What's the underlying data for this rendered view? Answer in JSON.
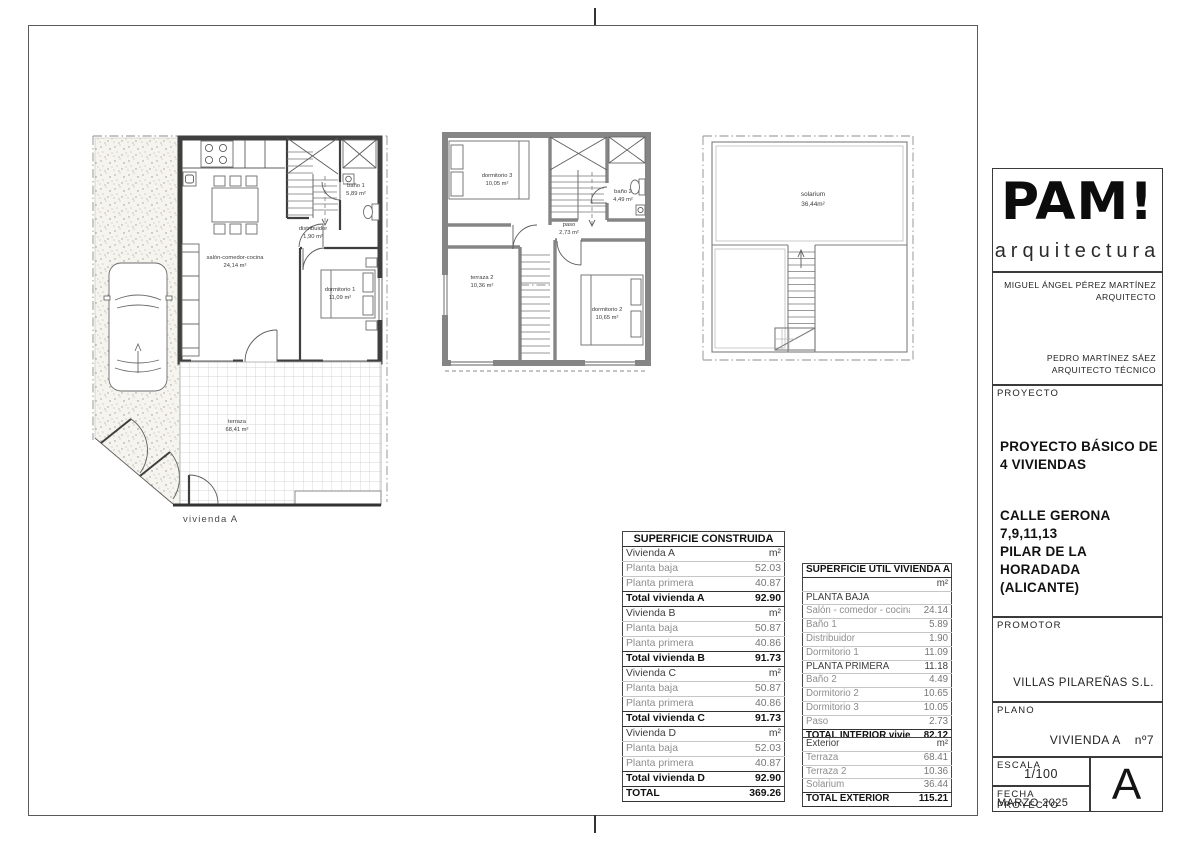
{
  "title_block": {
    "logo_title": "PAM!",
    "logo_subtitle": "arquitectura",
    "architect_name": "MIGUEL ÁNGEL PÉREZ MARTÍNEZ",
    "architect_role": "ARQUITECTO",
    "technical_architect_name": "PEDRO MARTÍNEZ SÁEZ",
    "technical_architect_role": "ARQUITECTO TÉCNICO",
    "proyecto_label": "PROYECTO",
    "project_title_line1": "PROYECTO BÁSICO DE",
    "project_title_line2": "4 VIVIENDAS",
    "address_line1": "CALLE GERONA",
    "address_line2": "7,9,11,13",
    "address_line3": "PILAR DE LA HORADADA",
    "address_line4": "(ALICANTE)",
    "promotor_label": "PROMOTOR",
    "promotor_name": "VILLAS PILAREÑAS S.L.",
    "plano_label": "PLANO",
    "plano_name": "VIVIENDA A",
    "plano_number": "nº7",
    "escala_label": "ESCALA",
    "escala_value": "1/100",
    "fecha_label": "FECHA PROYECTO",
    "fecha_value": "MARZO 2025",
    "sheet_letter": "A"
  },
  "plans": {
    "ground_floor": {
      "vivienda_label": "vivienda A",
      "rooms": {
        "salon": {
          "name": "salón-comedor-cocina",
          "area": "24,14 m²"
        },
        "distribuidor": {
          "name": "distribuidor",
          "area": "1,90 m²"
        },
        "bano1": {
          "name": "baño 1",
          "area": "5,89 m²"
        },
        "dormitorio1": {
          "name": "dormitorio 1",
          "area": "11,09 m²"
        },
        "terraza": {
          "name": "terraza",
          "area": "68,41 m²"
        }
      }
    },
    "first_floor": {
      "rooms": {
        "dormitorio3": {
          "name": "dormitorio 3",
          "area": "10,05 m²"
        },
        "bano2": {
          "name": "baño 2",
          "area": "4,49 m²"
        },
        "paso": {
          "name": "paso",
          "area": "2,73 m²"
        },
        "terraza2": {
          "name": "terraza 2",
          "area": "10,36 m²"
        },
        "dormitorio2": {
          "name": "dormitorio 2",
          "area": "10,65 m²"
        }
      }
    },
    "roof": {
      "rooms": {
        "solarium": {
          "name": "solarium",
          "area": "36,44m²"
        }
      }
    }
  },
  "tables": {
    "construida": {
      "title": "SUPERFICIE CONSTRUIDA",
      "rows": [
        {
          "label": "Vivienda A",
          "value": "m²"
        },
        {
          "label": "Planta baja",
          "value": "52.03"
        },
        {
          "label": "Planta primera",
          "value": "40.87"
        },
        {
          "label": "Total vivienda A",
          "value": "92.90"
        },
        {
          "label": "Vivienda B",
          "value": "m²"
        },
        {
          "label": "Planta baja",
          "value": "50.87"
        },
        {
          "label": "Planta primera",
          "value": "40.86"
        },
        {
          "label": "Total vivienda B",
          "value": "91.73"
        },
        {
          "label": "Vivienda C",
          "value": "m²"
        },
        {
          "label": "Planta baja",
          "value": "50.87"
        },
        {
          "label": "Planta primera",
          "value": "40.86"
        },
        {
          "label": "Total vivienda C",
          "value": "91.73"
        },
        {
          "label": "Vivienda D",
          "value": "m²"
        },
        {
          "label": "Planta baja",
          "value": "52.03"
        },
        {
          "label": "Planta primera",
          "value": "40.87"
        },
        {
          "label": "Total vivienda D",
          "value": "92.90"
        },
        {
          "label": "TOTAL",
          "value": "369.26"
        }
      ]
    },
    "util": {
      "title": "SUPERFICIE ÚTIL VIVIENDA A",
      "unit": "m²",
      "rows": [
        {
          "label": "PLANTA BAJA",
          "value": ""
        },
        {
          "label": "Salón - comedor - cocina",
          "value": "24.14"
        },
        {
          "label": "Baño 1",
          "value": "5.89"
        },
        {
          "label": "Distribuidor",
          "value": "1.90"
        },
        {
          "label": "Dormitorio 1",
          "value": "11.09"
        },
        {
          "label": "PLANTA PRIMERA",
          "value": "11.18"
        },
        {
          "label": "Baño 2",
          "value": "4.49"
        },
        {
          "label": "Dormitorio 2",
          "value": "10.65"
        },
        {
          "label": "Dormitorio 3",
          "value": "10.05"
        },
        {
          "label": "Paso",
          "value": "2.73"
        },
        {
          "label": "TOTAL INTERIOR vivienda",
          "value": "82.12"
        }
      ],
      "exterior_rows": [
        {
          "label": "Exterior",
          "value": "m²"
        },
        {
          "label": "Terraza",
          "value": "68.41"
        },
        {
          "label": "Terraza 2",
          "value": "10.36"
        },
        {
          "label": "Solarium",
          "value": "36.44"
        },
        {
          "label": "TOTAL EXTERIOR",
          "value": "115.21"
        }
      ]
    }
  }
}
